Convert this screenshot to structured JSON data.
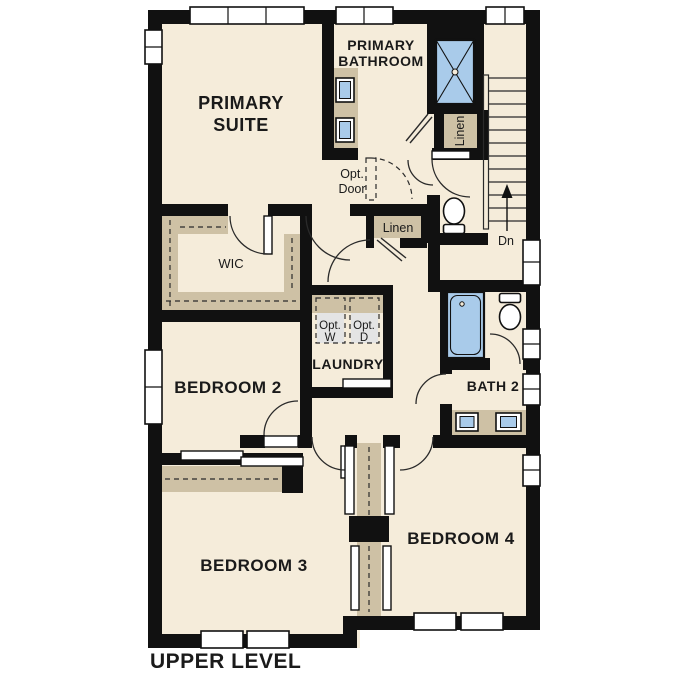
{
  "title": "UPPER LEVEL",
  "colors": {
    "floor": "#f5ecda",
    "wall": "#111111",
    "cabinet_tan": "#cec1a5",
    "fixture_blue": "#a9cbea",
    "appliance_gray": "#e4e4e4",
    "text": "#1a1a1a",
    "background": "#ffffff"
  },
  "rooms": {
    "primary_suite": {
      "line1": "PRIMARY",
      "line2": "SUITE"
    },
    "primary_bathroom": {
      "line1": "PRIMARY",
      "line2": "BATHROOM"
    },
    "wic": {
      "label": "WIC"
    },
    "bedroom2": {
      "label": "BEDROOM 2"
    },
    "laundry": {
      "label": "LAUNDRY"
    },
    "bath2": {
      "label": "BATH 2"
    },
    "bedroom3": {
      "label": "BEDROOM 3"
    },
    "bedroom4": {
      "label": "BEDROOM 4"
    }
  },
  "closets": {
    "linen_bath": "Linen",
    "linen_hall": "Linen"
  },
  "annotations": {
    "opt_door": {
      "line1": "Opt.",
      "line2": "Door"
    },
    "opt_washer": {
      "line1": "Opt.",
      "line2": "W"
    },
    "opt_dryer": {
      "line1": "Opt.",
      "line2": "D"
    },
    "stairs": {
      "down": "Dn"
    }
  }
}
